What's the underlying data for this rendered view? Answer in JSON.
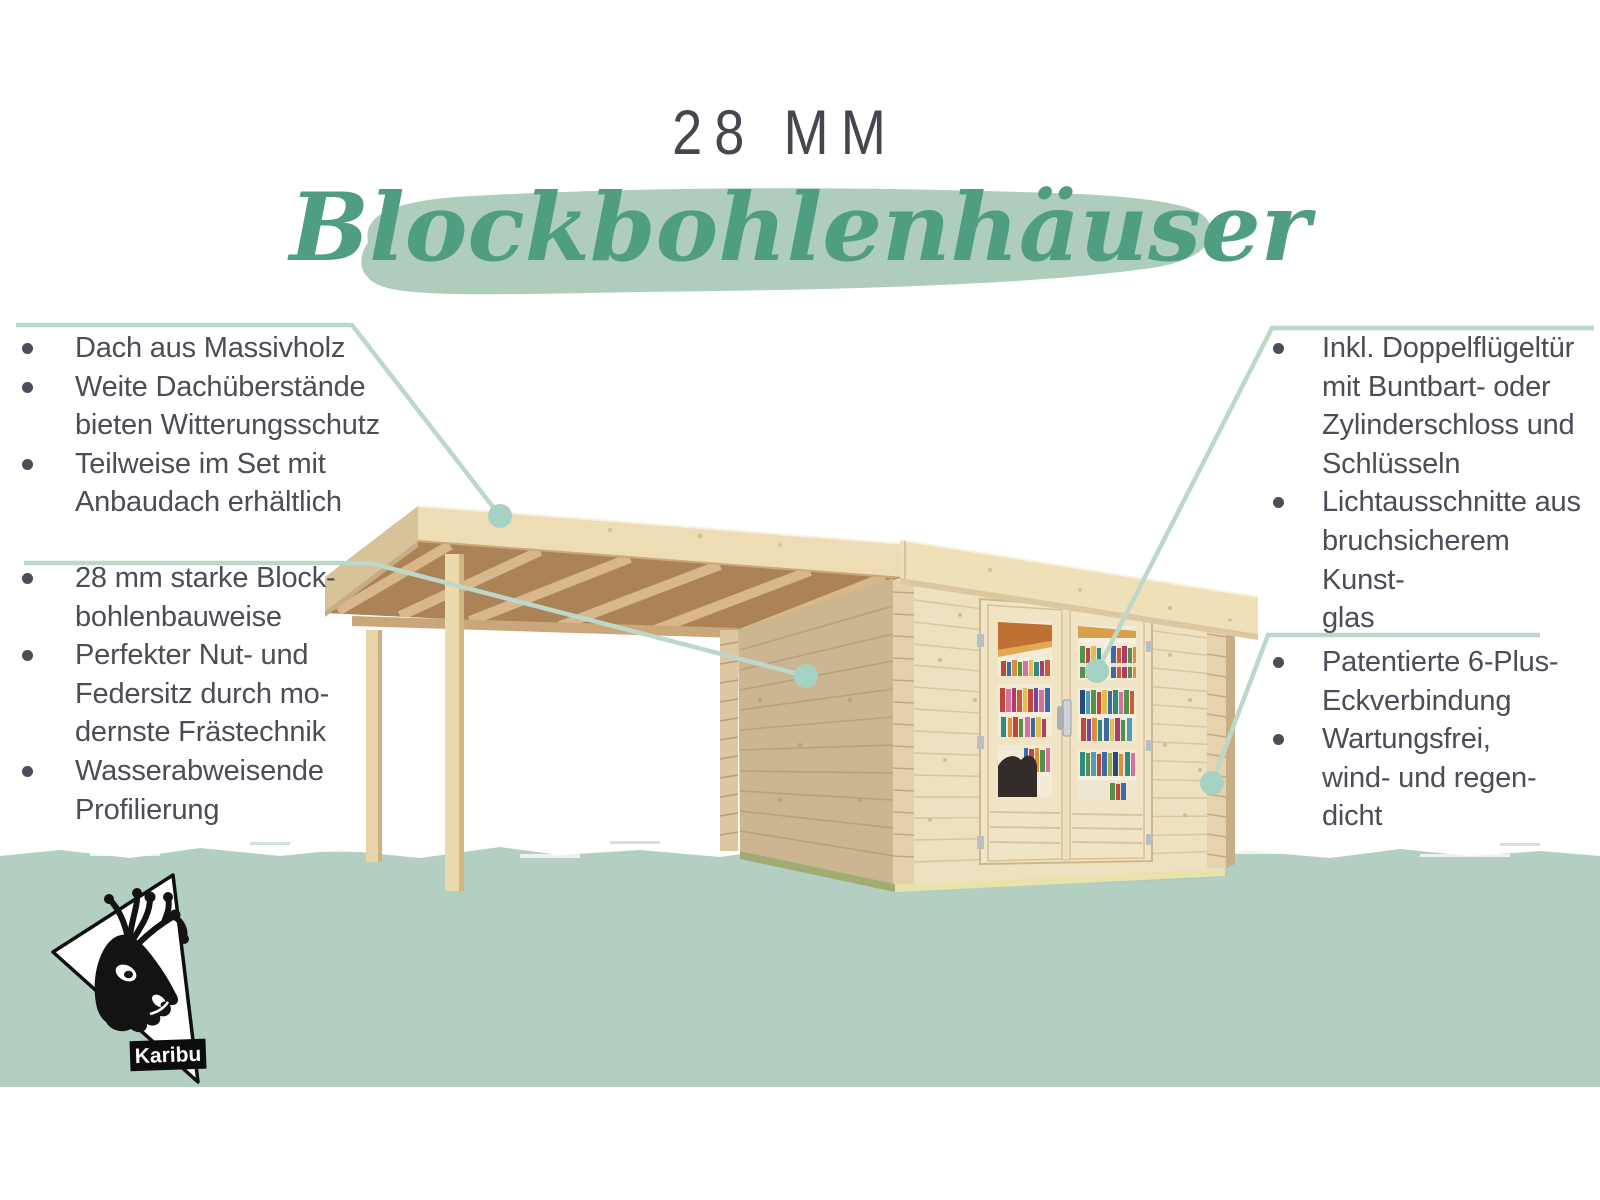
{
  "header": {
    "size_label": "28 MM",
    "product_label": "Blockbohlenhäuser"
  },
  "features": {
    "left_top": {
      "items": [
        {
          "lines": [
            "Dach aus Massivholz"
          ]
        },
        {
          "lines": [
            "Weite Dachüberstände",
            "bieten Witterungsschutz"
          ]
        },
        {
          "lines": [
            "Teilweise im Set mit",
            "Anbaudach erhältlich"
          ]
        }
      ]
    },
    "left_bottom": {
      "items": [
        {
          "lines": [
            "28 mm starke Block-",
            "bohlenbauweise"
          ]
        },
        {
          "lines": [
            "Perfekter Nut- und",
            "Federsitz durch mo-",
            "dernste Frästechnik"
          ]
        },
        {
          "lines": [
            "Wasserabweisende",
            "Profilierung"
          ]
        }
      ]
    },
    "right_top": {
      "items": [
        {
          "lines": [
            "Inkl. Doppelflügeltür",
            "mit Buntbart- oder",
            "Zylinderschloss und",
            "Schlüsseln"
          ]
        },
        {
          "lines": [
            "Lichtausschnitte aus",
            "bruchsicherem Kunst-",
            "glas"
          ]
        }
      ]
    },
    "right_bottom": {
      "items": [
        {
          "lines": [
            "Patentierte 6-Plus-",
            "Eckverbindung"
          ]
        },
        {
          "lines": [
            "Wartungsfrei,",
            "wind- und regen-",
            "dicht"
          ]
        }
      ]
    }
  },
  "logo": {
    "brand": "Karibu"
  },
  "colors": {
    "background": "#ffffff",
    "text_dark": "#4b4d57",
    "script_green": "#4f9e82",
    "brush_green": "#aecdbc",
    "callout_line": "#bdd8c9",
    "callout_circle": "#a6d2c4",
    "ground_band": "#b3cfc1",
    "wood_fascia": "#eddcb4",
    "wood_wall_front": "#eee1bf",
    "wood_wall_side": "#ccb591",
    "wood_soffit": "#ab8357",
    "base_olive": "#a2ac72",
    "base_pale": "#e8e3ac",
    "logo_black": "#111111"
  }
}
